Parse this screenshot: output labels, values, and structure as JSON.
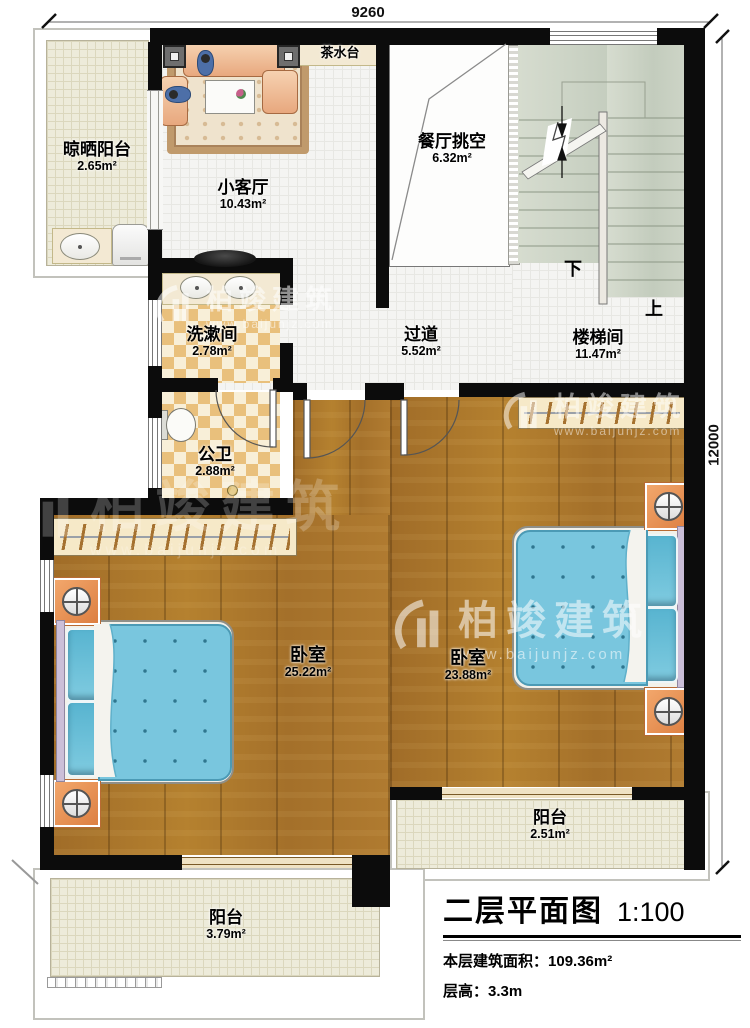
{
  "plan": {
    "title": "二层平面图",
    "scale": "1:100",
    "area_label": "本层建筑面积：",
    "area_value": "109.36m²",
    "height_label": "层高：",
    "height_value": "3.3m"
  },
  "dimensions": {
    "top_width": "9260",
    "right_height": "12000"
  },
  "watermark": {
    "brand": "柏竣建筑",
    "website": "www.baijunjz.com"
  },
  "stairs": {
    "down_label": "下",
    "up_label": "上"
  },
  "rooms": [
    {
      "id": "drying-balcony",
      "name": "晾晒阳台",
      "area": "2.65m²"
    },
    {
      "id": "living-room",
      "name": "小客厅",
      "area": "10.43m²"
    },
    {
      "id": "tea-counter",
      "name": "茶水台",
      "area": ""
    },
    {
      "id": "dining-void",
      "name": "餐厅挑空",
      "area": "6.32m²"
    },
    {
      "id": "stairwell",
      "name": "楼梯间",
      "area": "11.47m²"
    },
    {
      "id": "washroom",
      "name": "洗漱间",
      "area": "2.78m²"
    },
    {
      "id": "corridor",
      "name": "过道",
      "area": "5.52m²"
    },
    {
      "id": "toilet",
      "name": "公卫",
      "area": "2.88m²"
    },
    {
      "id": "bedroom-left",
      "name": "卧室",
      "area": "25.22m²"
    },
    {
      "id": "bedroom-right",
      "name": "卧室",
      "area": "23.88m²"
    },
    {
      "id": "balcony-right",
      "name": "阳台",
      "area": "2.51m²"
    },
    {
      "id": "balcony-left",
      "name": "阳台",
      "area": "3.79m²"
    }
  ],
  "colors": {
    "wall": "#0c0c0c",
    "wood_floor": "#aa762e",
    "tile_floor": "#f4f4f2",
    "checker_tile": "#e9c07c",
    "balcony_floor": "#edebda",
    "stair_tread": "#cfd6c9",
    "bed_blue": "#79c6de",
    "nightstand_orange": "#e9914f",
    "sofa_salmon": "#eebf9a",
    "wardrobe_cream": "#f6e9c8"
  }
}
